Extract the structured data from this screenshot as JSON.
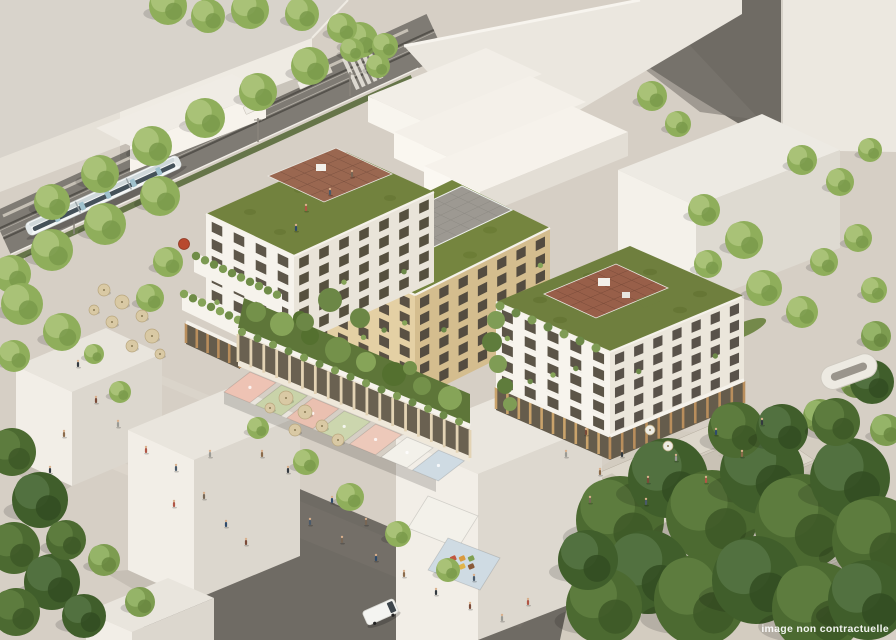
{
  "caption": {
    "watermark": "image non contractuelle"
  },
  "scene_elements": [
    "apartment-building-white-northwest",
    "apartment-building-tan-center",
    "apartment-building-white-southeast",
    "green-roofs-with-terraces",
    "courtyard-garden",
    "ground-floor-shops-arcade",
    "market-awnings",
    "cafe-umbrellas",
    "tram-line-with-tram",
    "pedestrian-plaza",
    "stepped-plaza",
    "street-trees",
    "surrounding-massing-blocks",
    "pedestrians",
    "delivery-van"
  ],
  "palette": {
    "ground": "#d6cfc5",
    "shadow_plaza": "#6f6b64",
    "tram_corridor": "#7f7b74",
    "facade_white": "#f6f3ec",
    "facade_tan": "#e4d0a4",
    "green_roof": "#74843f",
    "roof_terrace_brown": "#9a6750",
    "roof_terrace_grey": "#9d9992",
    "tree_light": "#8fae5b",
    "tree_dark": "#4c6a31",
    "awning_pink": "#eec3b4",
    "awning_sage": "#c9d3a9",
    "awning_white": "#f3f1ea",
    "awning_blue": "#cfdbe3",
    "umbrella_tan": "#d9c9a4",
    "umbrella_red": "#b8492f",
    "caption_text": "#ffffff"
  }
}
